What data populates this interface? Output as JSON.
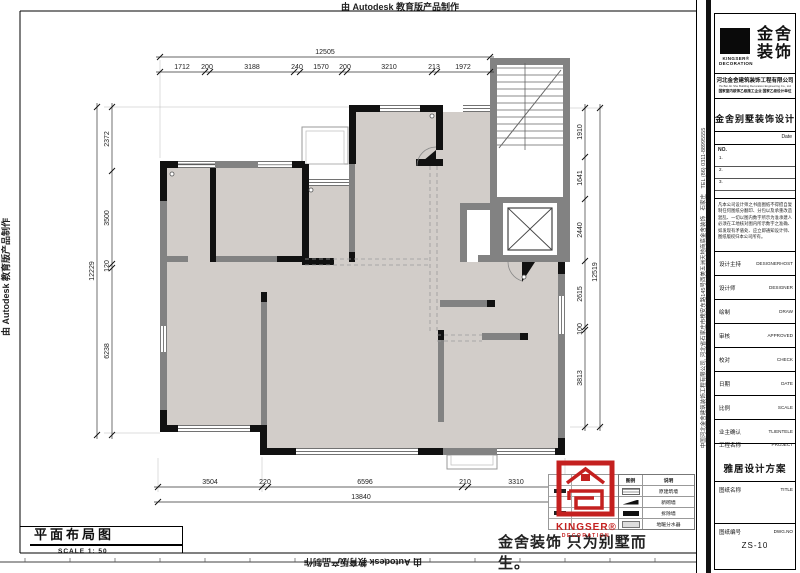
{
  "stamps": {
    "autodesk": "由 Autodesk 教育版产品制作"
  },
  "titleblock": {
    "logo_cn": "金舍",
    "logo_cn2": "装饰",
    "brand_en": "KINGSER®",
    "brand_en2": "DECORATION",
    "company": "河北金舍建筑装饰工程有限公司",
    "company_en": "He Bei Jin She Building Decoration Engineering Co., Ltd",
    "company_note": "国家室内装饰乙级施工企业 国家乙级设计单位",
    "program": "金舍别墅装饰设计",
    "date_label": "Date",
    "no_label": "NO.",
    "rev_rows": [
      "1.",
      "2.",
      "3."
    ],
    "disclaimer": "凡本公司设计师之书面图纸不得擅自复制任何图纸分翻印、分包以及承重改造混乱、一切以图内数字所示为准承建人必须在工地核对图内所示数字之准确、如发现有矛盾处、应立即通知设计师、图纸版权归本公司所有。",
    "rows": [
      {
        "cn": "设计主持",
        "en": "DESIGNERHOST"
      },
      {
        "cn": "设计师",
        "en": "DESIGNER"
      },
      {
        "cn": "绘制",
        "en": "DRAW"
      },
      {
        "cn": "审核",
        "en": "APPROVED"
      },
      {
        "cn": "校对",
        "en": "CHECK"
      },
      {
        "cn": "日期",
        "en": "DATE"
      },
      {
        "cn": "比例",
        "en": "SCALE"
      },
      {
        "cn": "业主确认",
        "en": "TLIENTELE"
      }
    ],
    "project_label_cn": "工程名称",
    "project_label_en": "PROJECT",
    "project_value": "雅居设计方案",
    "title_label_cn": "图纸名称",
    "title_label_en": "TITLE",
    "dwg_label_cn": "图纸编号",
    "dwg_label_en": "DWG.NO",
    "dwg_value": "ZS-10",
    "side_address": "中国河北金舍建筑装饰工程有限公司, 河北省石家庄市槐安东路145号西美五洲天地商底金舍装饰　石家庄　TEL (86) 0311-88995555"
  },
  "footer": {
    "drawing_title": "平面布局图",
    "scale_text": "SCALE 1: 50",
    "slogan": "金舍装饰 只为别墅而生。"
  },
  "legend": {
    "headers": [
      "图例",
      "说明"
    ],
    "rows": [
      "原建筑墙",
      "新砌墙",
      "拆除墙",
      "地暖分水器"
    ]
  },
  "red_stamp": {
    "en1": "KINGSER®",
    "en2": "DECORATION"
  },
  "dims": {
    "top": {
      "total": "12505",
      "segs": [
        "1712",
        "200",
        "3188",
        "240",
        "1570",
        "200",
        "3210",
        "213",
        "1972"
      ]
    },
    "left": {
      "total": "12229",
      "segs": [
        "2372",
        "3500",
        "120",
        "6238"
      ]
    },
    "right": {
      "total": "12519",
      "segs": [
        "1910",
        "1641",
        "2440",
        "2615",
        "100",
        "3813"
      ]
    },
    "bottom": {
      "total": "13840",
      "segs": [
        "3504",
        "220",
        "6596",
        "210",
        "3310"
      ]
    }
  }
}
